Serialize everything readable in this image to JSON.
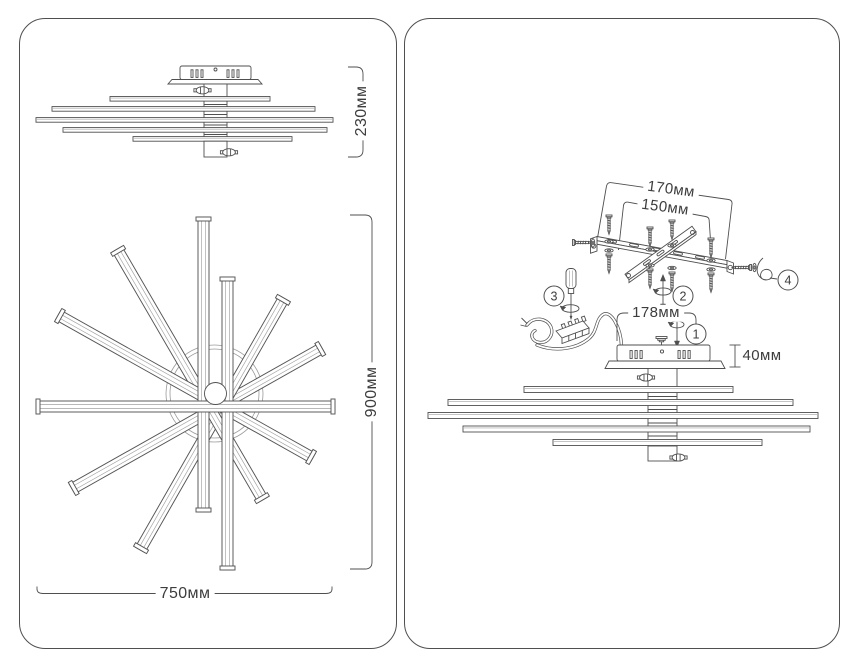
{
  "colors": {
    "line": "#4f4f4f",
    "line_light": "#9a9a9a",
    "text": "#3d3d3d",
    "background": "#ffffff",
    "panel_border": "#4f4f4f"
  },
  "left_panel": {
    "description": "overall dimension drawings",
    "labels": {
      "side_height": "230мм",
      "front_height": "900мм",
      "front_width": "750мм"
    }
  },
  "right_panel": {
    "description": "installation assembly diagram",
    "labels": {
      "bracket_outer_width": "170мм",
      "bracket_hole_spacing": "150мм",
      "canopy_width": "178мм",
      "canopy_height": "40мм"
    },
    "step_callouts": [
      "1",
      "2",
      "3",
      "4"
    ]
  }
}
